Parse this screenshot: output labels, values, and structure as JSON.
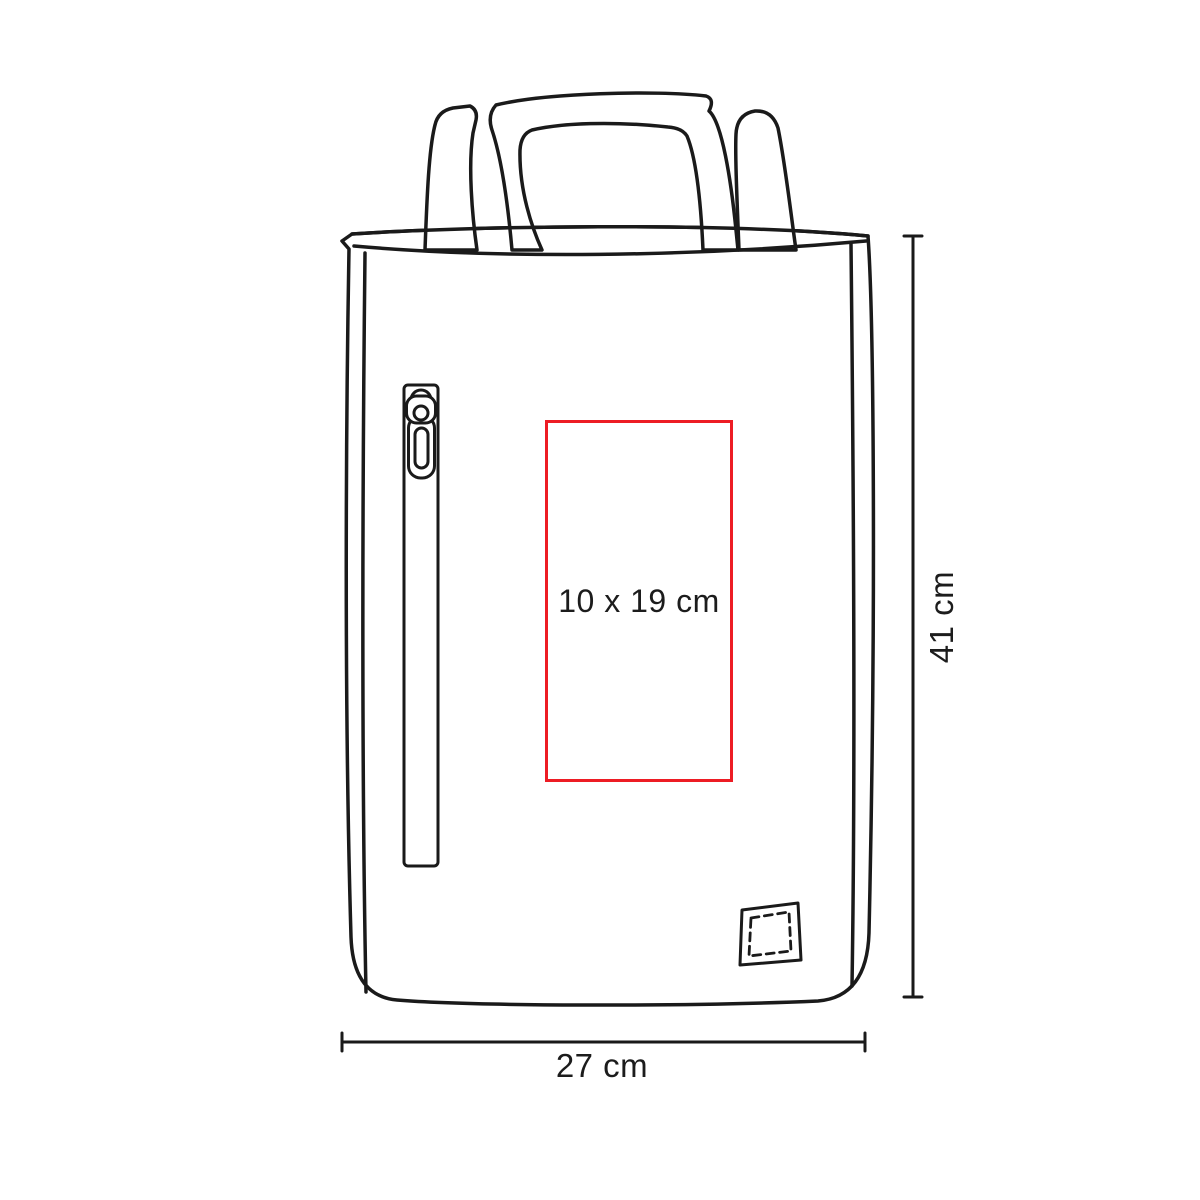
{
  "diagram": {
    "product_shape": "tote-bag-line-drawing",
    "print_area": {
      "label": "10 x 19 cm",
      "border_color": "#ed1c24"
    },
    "dimensions": {
      "height": {
        "label": "41 cm"
      },
      "width": {
        "label": "27 cm"
      }
    },
    "colors": {
      "line": "#1a1a1a",
      "print_area_red": "#ed1c24",
      "background": "#ffffff"
    },
    "icons": {
      "zipper": "zipper-pull-icon",
      "patch": "stitched-label-patch-icon"
    }
  }
}
